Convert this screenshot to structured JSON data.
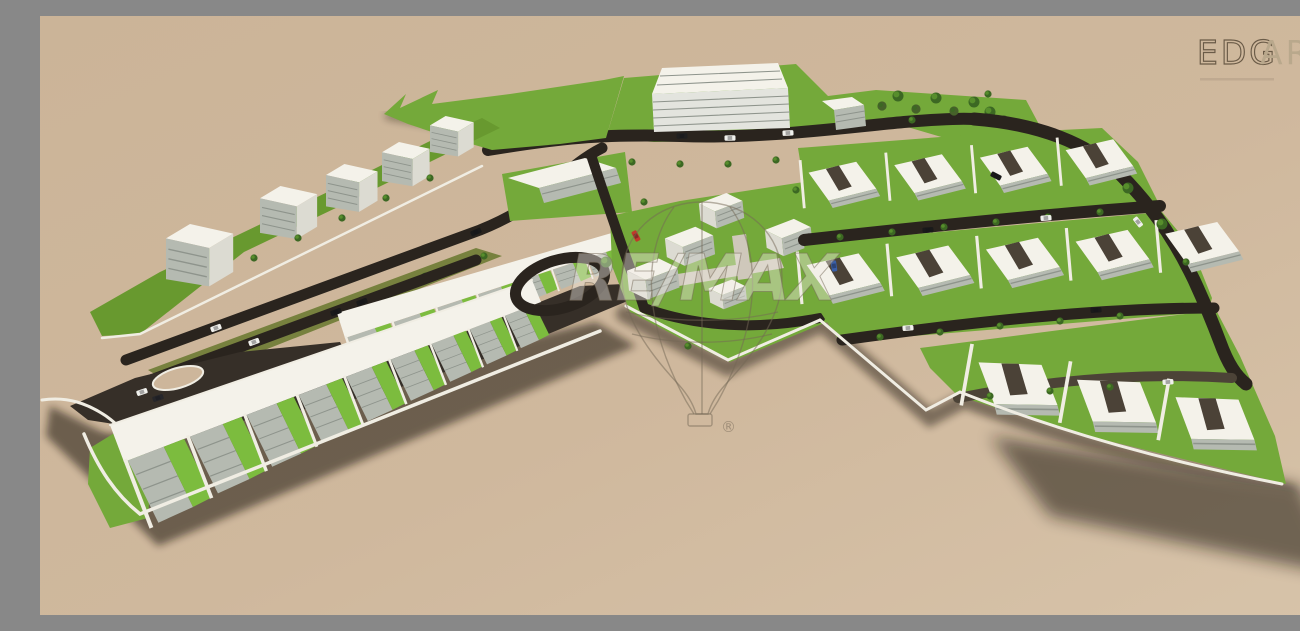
{
  "page": {
    "title": "Aerial 3D architectural rendering of a residential development"
  },
  "scene": {
    "description": "Bird's-eye 3D render of a planned housing estate on beige ground: long terraced house rows with green yards, mid-rise apartment blocks along a tree-lined boulevard, a large banded building at the top, clusters of detached villas with dark courtyards on the right, dark asphalt roads, lawns, trees and cars.",
    "districts": [
      "northwest-boulevard-blocks",
      "north-large-building-and-park",
      "southwest-terraced-rows",
      "central-villa-cluster",
      "east-villa-rows"
    ]
  },
  "branding": {
    "logo_primary": "EDG",
    "logo_secondary": "ART"
  },
  "watermark": {
    "brand": "RE/MAX",
    "registered": "®"
  },
  "colors": {
    "ground": "#cdb69b",
    "ground_light": "#d7c3a9",
    "grass": "#74a93a",
    "grass_bright": "#7cbc3e",
    "grass_strip": "#68992f",
    "median": "#77813e",
    "road": "#2a241e",
    "asphalt": "#362f28",
    "road_brown": "#4c4337",
    "roof": "#f4f2ea",
    "wall": "#f0ede3",
    "facade": "#b5bab1",
    "facade_line": "#8e948c",
    "side": "#dcdbd2",
    "courtyard": "#4b4237",
    "tree": "#3c6823",
    "tree_light": "#578e2c",
    "bush": "#46622a",
    "walkway": "#cfc8bb",
    "shadow": "#1c150e",
    "logo_dark": "#6a5b47",
    "logo_faint": "#b9a88c",
    "watermark_line": "rgba(115,103,85,0.5)",
    "watermark_fill": "rgba(240,236,228,0.42)"
  }
}
